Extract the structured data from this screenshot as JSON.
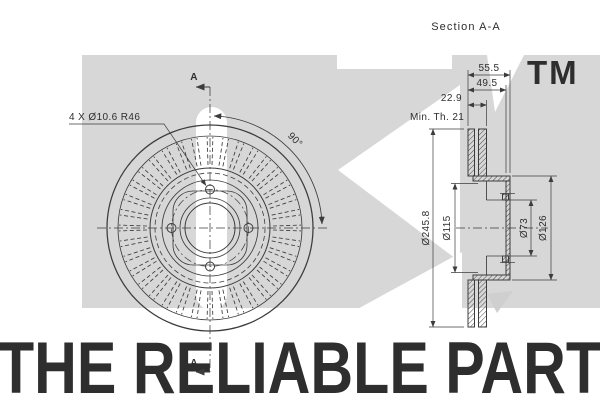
{
  "section_title": "Section A-A",
  "watermark": {
    "tm": "TM",
    "tagline": "THE RELIABLE PART"
  },
  "front_view": {
    "hole_note": "4 X Ø10.6 R46",
    "angle_label": "90°",
    "section_label_top": "A",
    "section_label_bottom": "A"
  },
  "section_view": {
    "dim_total_width": "55.5",
    "dim_inner_width": "49.5",
    "dim_thickness": "22.9",
    "dim_min_thickness": "Min. Th. 21",
    "dim_outer_diameter": "Ø245.8",
    "dim_bolt_circle": "Ø115",
    "dim_bore": "Ø73",
    "dim_hub": "Ø126"
  },
  "colors": {
    "line": "#3c3c3c",
    "watermark_gray": "#d7d7d7",
    "watermark_text": "#ebebeb",
    "tagline_gray": "#dedede",
    "wedge_gray": "#cfcfcf"
  }
}
